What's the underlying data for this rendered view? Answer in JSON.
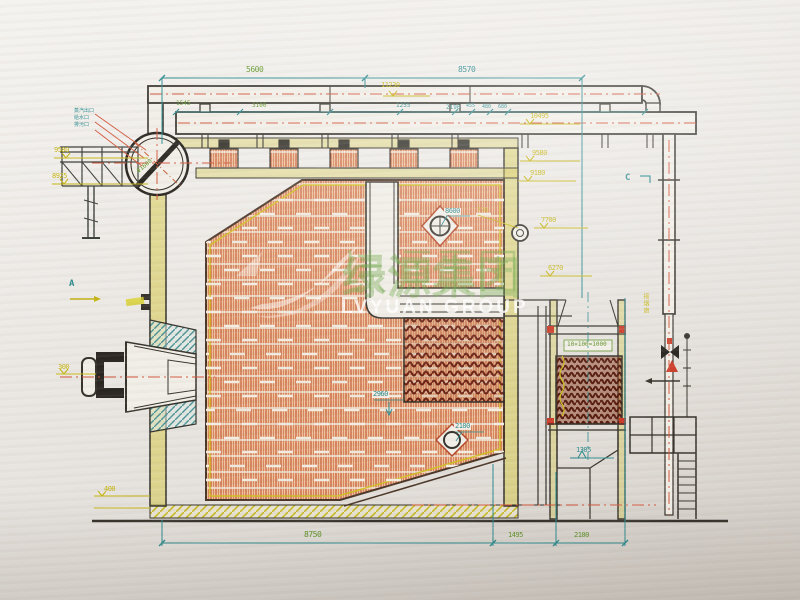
{
  "palette": {
    "teal": "#2a8a8e",
    "yellow": "#c5b513",
    "green": "#5e9427",
    "orange": "#c65a32",
    "red": "#cc3b28",
    "ink": "#35322b",
    "paper": "#e9e6e2"
  },
  "watermark": {
    "cn": "绿源集团",
    "en": "LVYUAN GROUP"
  },
  "dims": {
    "top_left": "5600",
    "top_right": "8570",
    "sub": [
      "1545",
      "3100",
      "1255",
      "455",
      "480",
      "680",
      "2190"
    ],
    "bottom": [
      "8750",
      "1495",
      "2100"
    ],
    "furnace_width": "8600",
    "stub": "770",
    "rear_depth": "2960",
    "manhole": "2100",
    "econ_note": "10×100=1000"
  },
  "levels": {
    "right": [
      "11230",
      "10495",
      "9580",
      "9180",
      "7700",
      "6270"
    ],
    "left": [
      "9580",
      "8925"
    ],
    "outlet": "1305",
    "low_left": "400",
    "burner": "300"
  },
  "markers": {
    "a": "A",
    "c": "C"
  },
  "notes": {
    "chimney": "接烟囱",
    "drum": "Φ1600",
    "nozzles": [
      "蒸汽出口",
      "给水口",
      "排污口"
    ]
  }
}
